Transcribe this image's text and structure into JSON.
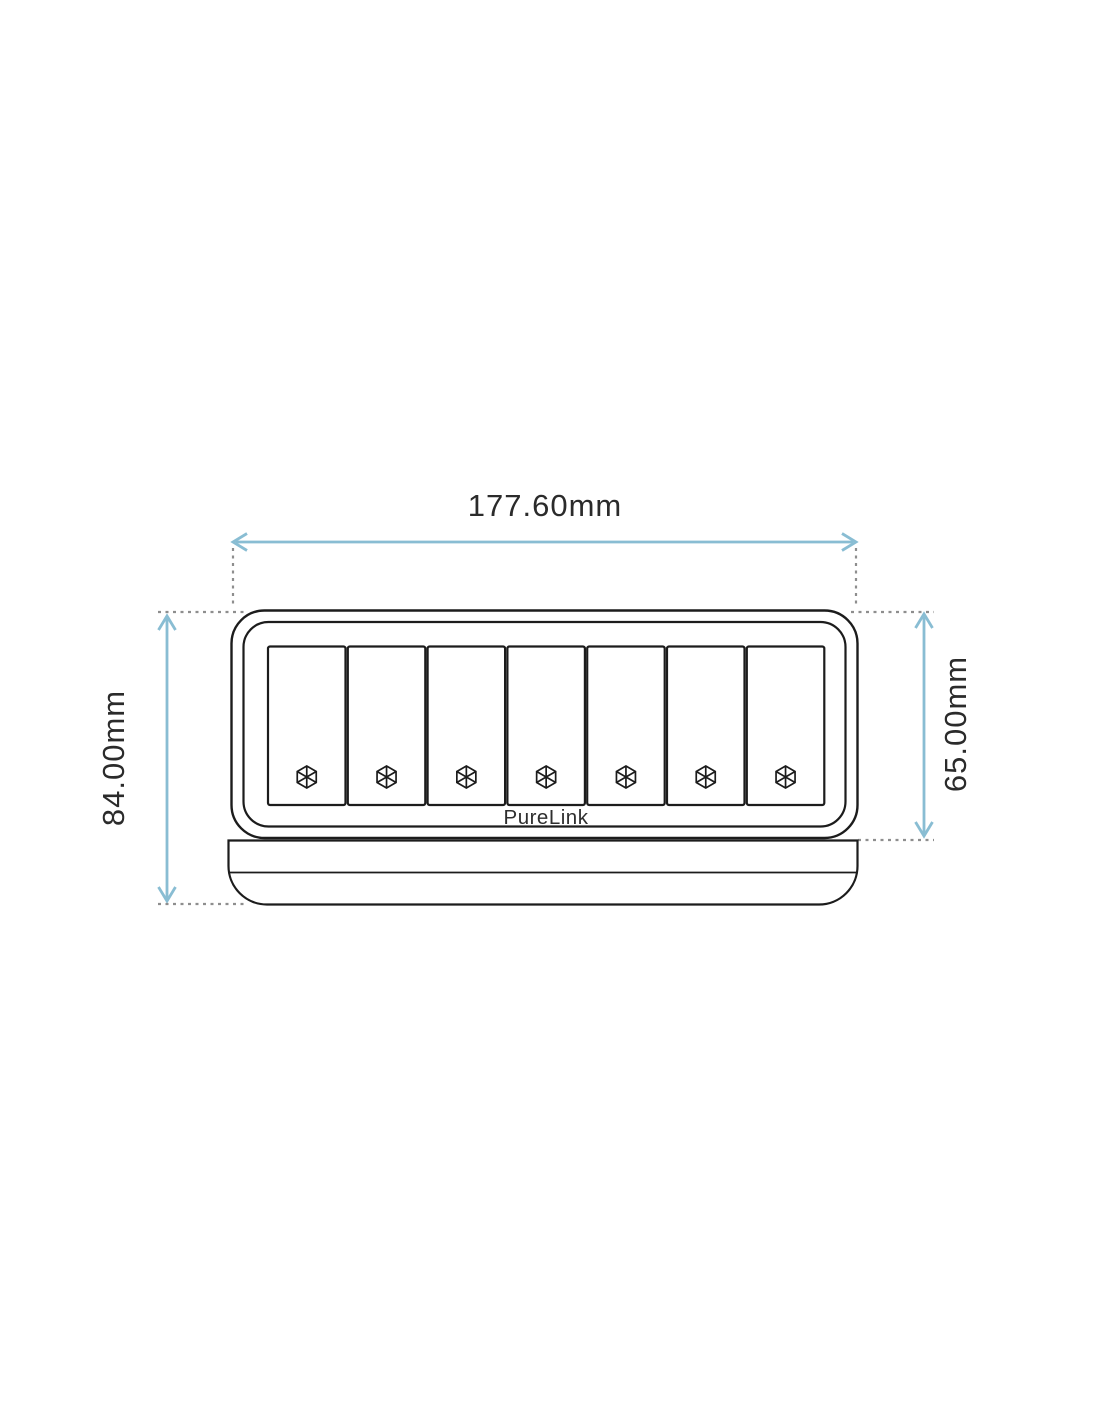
{
  "title": "PureLink keypad dimension drawing",
  "dimensions": {
    "width": {
      "label": "177.60mm"
    },
    "height_total": {
      "label": "84.00mm"
    },
    "height_panel": {
      "label": "65.00mm"
    }
  },
  "device": {
    "brand": "PureLink",
    "button_count": 7,
    "button_icon": "hex-wheel-icon"
  },
  "colors": {
    "dimension_arrow": "#89bdd3",
    "extension_line": "#8e8e8e",
    "outline": "#1c1c1c",
    "label_text": "#2b2b2b",
    "background": "#ffffff"
  }
}
